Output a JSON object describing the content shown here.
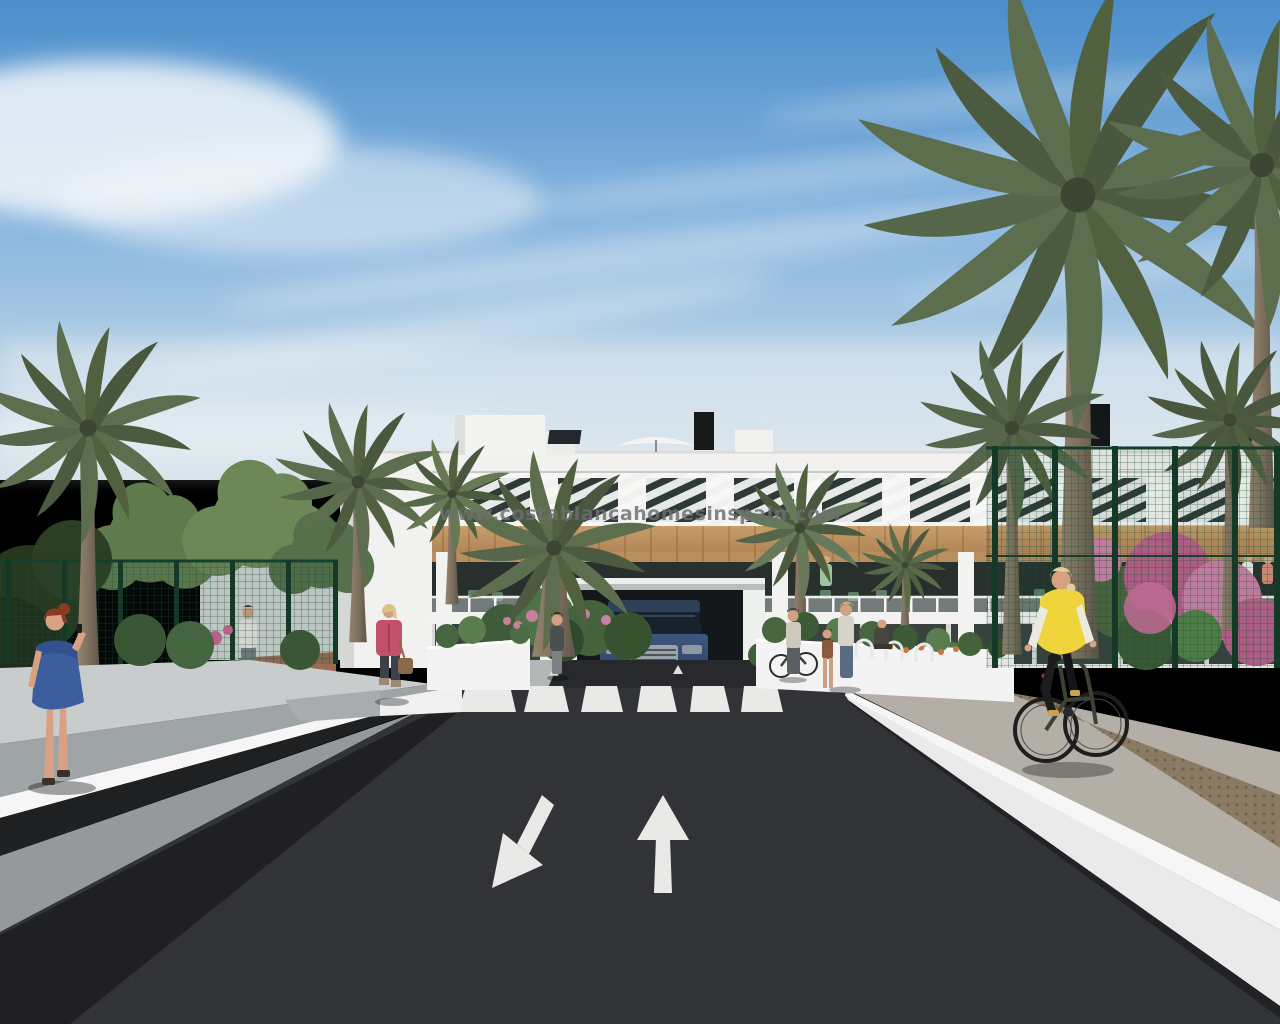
{
  "watermark": {
    "text": "www.costablancahomesinspain.com"
  },
  "scene": {
    "type": "3d-architectural-render",
    "subject": "modern white apartment complex entrance street scene with palm trees",
    "road_markings": {
      "crosswalk_stripes": 6,
      "lane_arrows": [
        "toward-viewer-down-left",
        "away-from-viewer-up"
      ]
    },
    "figures": [
      "woman-on-phone-blue-dress",
      "man-walking-background",
      "woman-pink-jacket-with-bag",
      "woman-standing-at-entrance",
      "woman-with-bicycle",
      "parent-with-child",
      "seated-person",
      "cyclist-yellow-vest"
    ],
    "vehicle": "dark-blue-suv-at-entrance"
  },
  "colors": {
    "sky_top": "#4b8ecb",
    "sky_mid": "#9ec4e4",
    "sky_haze": "#d7e3ea",
    "building_white": "#f1f2f0",
    "wood_tone": "#bd9160",
    "window_dark": "#2e3a36",
    "palm_green": "#5d6e4e",
    "palm_green_dark": "#46543b",
    "trunk_brown": "#7d6f5d",
    "fence_green": "#1f4c36",
    "hedge_green": "#3f5c3a",
    "flower_pink": "#c97fa2",
    "road_asphalt": "#2b2d30",
    "sidewalk_gray": "#95999b",
    "paver_gray": "#b3aea6",
    "paver_brown": "#8b7b64",
    "wall_white": "#f5f6f5",
    "marking_white": "#e9eae7",
    "car_blue": "#3a5378",
    "dress_blue": "#3c5d9e",
    "jacket_pink": "#c2506b",
    "vest_yellow": "#f0d43c",
    "watermark_gray": "#6d6e74"
  }
}
